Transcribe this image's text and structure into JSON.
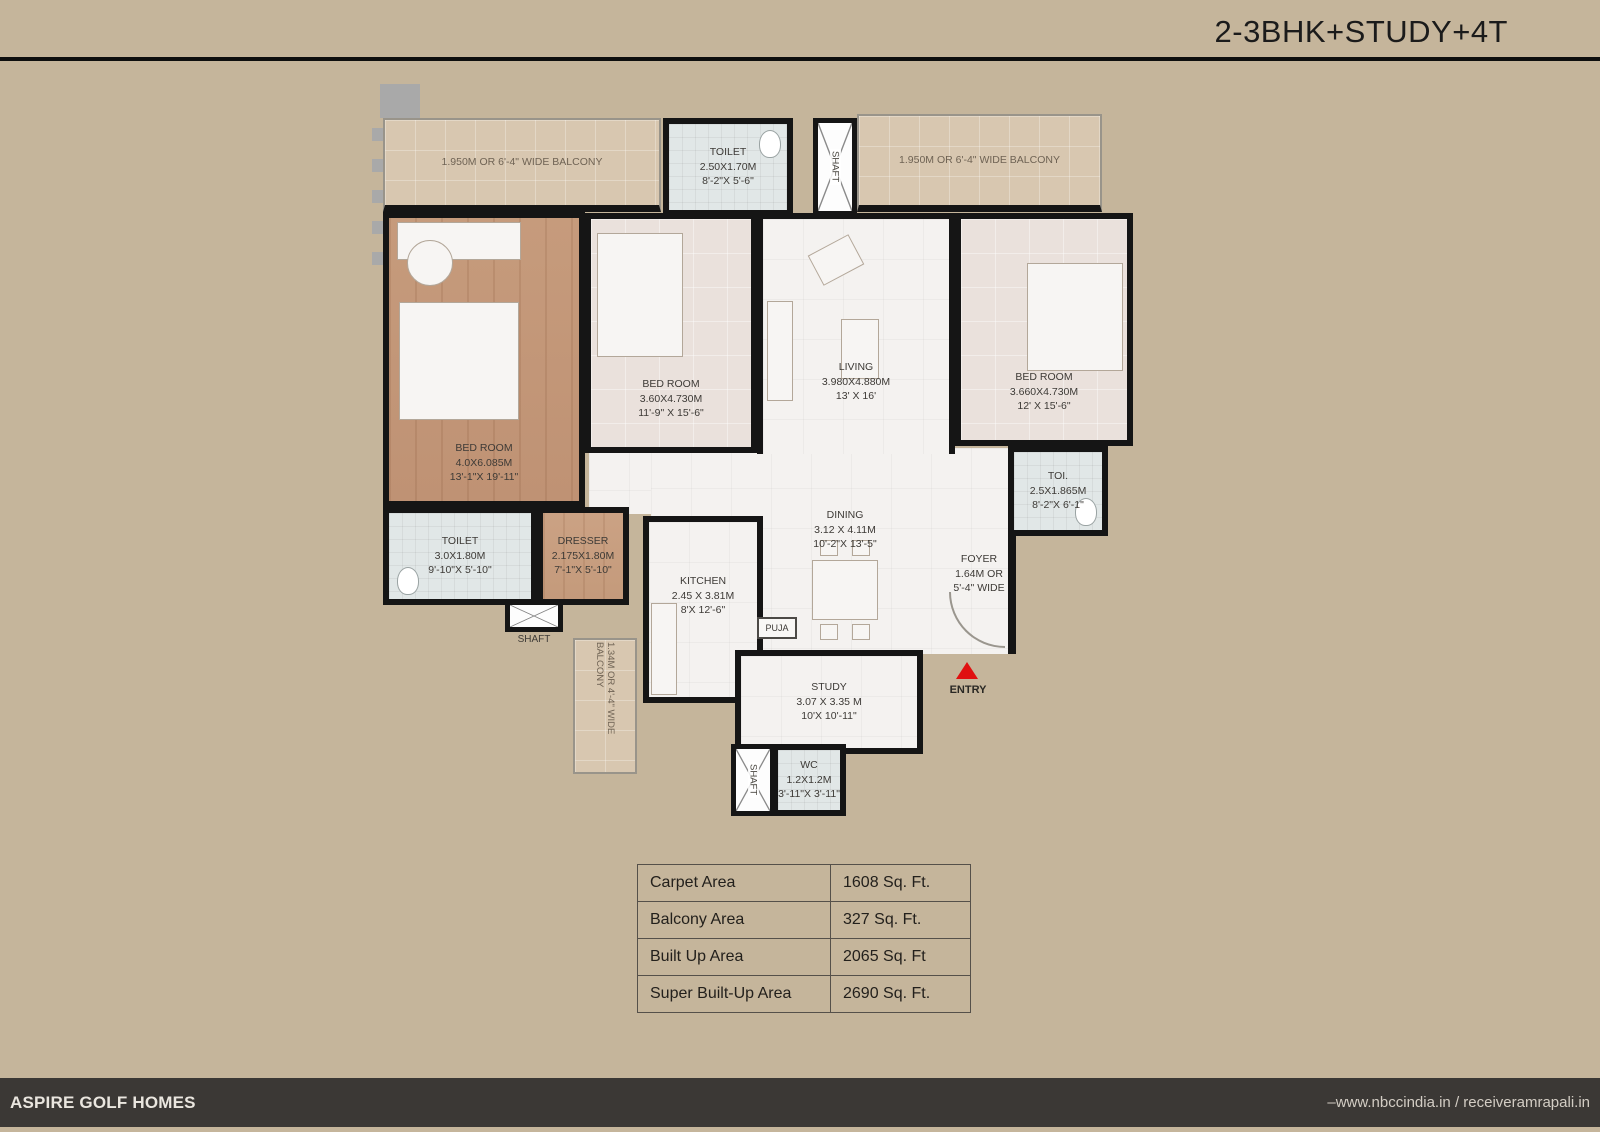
{
  "page": {
    "title": "2-3BHK+STUDY+4T",
    "footer": {
      "brand": "ASPIRE GOLF HOMES",
      "website": "–www.nbccindia.in / receiveramrapali.in"
    }
  },
  "colors": {
    "background": "#c5b59b",
    "wall": "#151515",
    "footer_bar": "#3b3835",
    "entry_arrow": "#e01010",
    "balcony_fill": "#d8c7b0",
    "wood_floor": "#c69b7c"
  },
  "floor_plan": {
    "rooms": {
      "balcony_left": {
        "name": "1.950M OR 6'-4\" WIDE BALCONY"
      },
      "balcony_right": {
        "name": "1.950M OR 6'-4\" WIDE BALCONY"
      },
      "balcony_bottom": {
        "name": "1.34M OR 4'-4\" WIDE  BALCONY"
      },
      "toilet_top": {
        "name": "TOILET",
        "dims_m": "2.50X1.70M",
        "dims_ft": "8'-2\"X 5'-6\""
      },
      "bedroom_master": {
        "name": "BED ROOM",
        "dims_m": "4.0X6.085M",
        "dims_ft": "13'-1\"X 19'-11\""
      },
      "bedroom_2": {
        "name": "BED ROOM",
        "dims_m": "3.60X4.730M",
        "dims_ft": "11'-9\" X 15'-6\""
      },
      "living": {
        "name": "LIVING",
        "dims_m": "3.980X4.880M",
        "dims_ft": "13' X 16'"
      },
      "bedroom_3": {
        "name": "BED ROOM",
        "dims_m": "3.660X4.730M",
        "dims_ft": "12' X 15'-6\""
      },
      "toi_right": {
        "name": "TOI.",
        "dims_m": "2.5X1.865M",
        "dims_ft": "8'-2\"X 6'-1\""
      },
      "toilet_left": {
        "name": "TOILET",
        "dims_m": "3.0X1.80M",
        "dims_ft": "9'-10\"X 5'-10\""
      },
      "dresser": {
        "name": "DRESSER",
        "dims_m": "2.175X1.80M",
        "dims_ft": "7'-1\"X 5'-10\""
      },
      "kitchen": {
        "name": "KITCHEN",
        "dims_m": "2.45 X 3.81M",
        "dims_ft": "8'X 12'-6\""
      },
      "dining": {
        "name": "DINING",
        "dims_m": "3.12 X 4.11M",
        "dims_ft": "10'-2\"X 13'-5\""
      },
      "foyer": {
        "name": "FOYER",
        "dims_m": "1.64M OR",
        "dims_ft": "5'-4\" WIDE"
      },
      "study": {
        "name": "STUDY",
        "dims_m": "3.07 X 3.35 M",
        "dims_ft": "10'X 10'-11\""
      },
      "wc": {
        "name": "WC",
        "dims_m": "1.2X1.2M",
        "dims_ft": "3'-11\"X 3'-11\""
      },
      "puja": {
        "name": "PUJA"
      },
      "shaft_top": {
        "name": "SHAFT"
      },
      "shaft_left": {
        "name": "SHAFT"
      },
      "shaft_wc": {
        "name": "SHAFT"
      },
      "entry": {
        "name": "ENTRY"
      }
    }
  },
  "area_table": {
    "rows": [
      {
        "label": "Carpet Area",
        "value": "1608 Sq. Ft."
      },
      {
        "label": "Balcony Area",
        "value": "327 Sq. Ft."
      },
      {
        "label": "Built Up Area",
        "value": "2065 Sq. Ft"
      },
      {
        "label": "Super Built-Up Area",
        "value": "2690 Sq. Ft."
      }
    ]
  }
}
